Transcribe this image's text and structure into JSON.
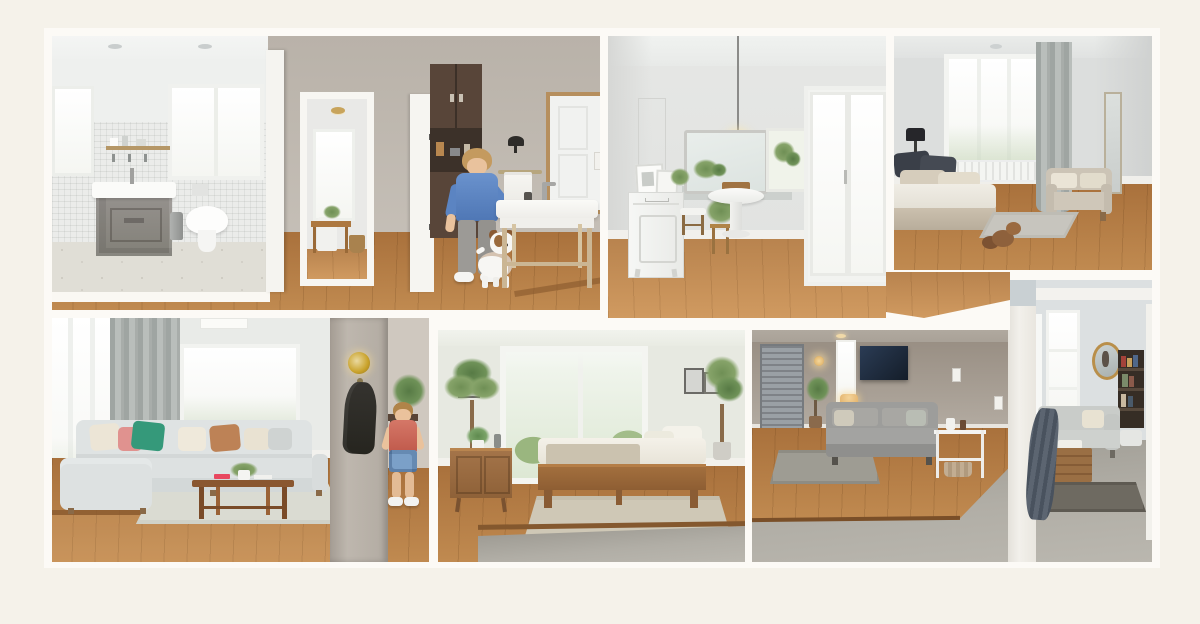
{
  "scene": {
    "type": "interior photo collage",
    "style": "dollhouse cutaway of a furnished home, six room views in two rows",
    "frame_color": "#f5f2ea",
    "mat_color": "#fcfaf6",
    "divider_color": "#fbf9f4"
  },
  "palette": {
    "oak_floor": "#b07c46",
    "light_oak_floor": "#c08a50",
    "concrete_floor": "#a5a29d",
    "wall_warm_gray": "#c6c0b8",
    "wall_cool_gray": "#e4e6e4",
    "wall_taupe": "#a9a198",
    "wall_blue_gray": "#dce0e1",
    "sofa_light_gray": "#dfe3e3",
    "pillow_green": "#35997a",
    "pillow_pink": "#e0928f",
    "pillow_tan": "#bd8256",
    "walnut_table": "#8a5730",
    "brass": "#c9a22a",
    "child_shirt_blue": "#5b84c2",
    "child_shirt_red": "#cd685a",
    "dog_white": "#f7f6f3",
    "dog_brown": "#8a5a33",
    "tv_navy": "#1f2c3c",
    "slate_throw": "#57606c"
  },
  "rooms": [
    {
      "id": "bathroom-hallway",
      "name": "Bathroom and hallway with child and dog",
      "objects": [
        "mosaic tile walls",
        "gray vanity with vessel sink",
        "wall-hung toilet",
        "two windows",
        "open shelf",
        "trash can",
        "doorway to dining nook",
        "dark pantry cabinet",
        "boy in blue t-shirt",
        "jack russell terrier",
        "black wall sconce",
        "towel bar",
        "wood console washstand",
        "leaning framed mirror",
        "oak floor with step"
      ]
    },
    {
      "id": "dining-room",
      "name": "Dining room",
      "objects": [
        "glass globe pendant",
        "large wall mirror",
        "white dresser with leaning art",
        "potted plants",
        "white pedestal basin table",
        "wood stool with cushion",
        "sliding glass doors",
        "oak plank floor"
      ]
    },
    {
      "id": "bedroom",
      "name": "Bedroom",
      "objects": [
        "platform bed with charcoal and beige pillows",
        "table lamp",
        "window with radiator",
        "gray curtain",
        "beige loveseat",
        "slim wall mirror",
        "gray rug",
        "plush dog toy",
        "oak floor"
      ]
    },
    {
      "id": "living-room",
      "name": "Living room with child",
      "objects": [
        "floor-to-ceiling windows",
        "gray curtains",
        "sectional sofa",
        "green pink and tan pillows",
        "walnut coffee table with plant and red book",
        "light area rug",
        "wall column with brass sconce and hanging coat",
        "desk with palm plant",
        "boy in red shirt and blue shorts",
        "oak floor with step"
      ]
    },
    {
      "id": "guest-bedroom",
      "name": "Guest bedroom",
      "objects": [
        "picture window with trees",
        "tall palm plant",
        "mid-century console with aloe",
        "framed art",
        "potted tree",
        "wood daybed with fringed throw",
        "beige rug",
        "oak floor meeting concrete"
      ]
    },
    {
      "id": "family-room",
      "name": "Family room and sunroom",
      "objects": [
        "gray louvered door",
        "warm sconce",
        "plant and side table",
        "wall-mounted tv",
        "gray sofa",
        "white etagere with basket",
        "patterned rug",
        "tall windows",
        "round gold mirror",
        "built-in bookshelf",
        "light sofa",
        "wood crate table",
        "slate draped throw",
        "dark rug",
        "concrete floor"
      ]
    }
  ]
}
